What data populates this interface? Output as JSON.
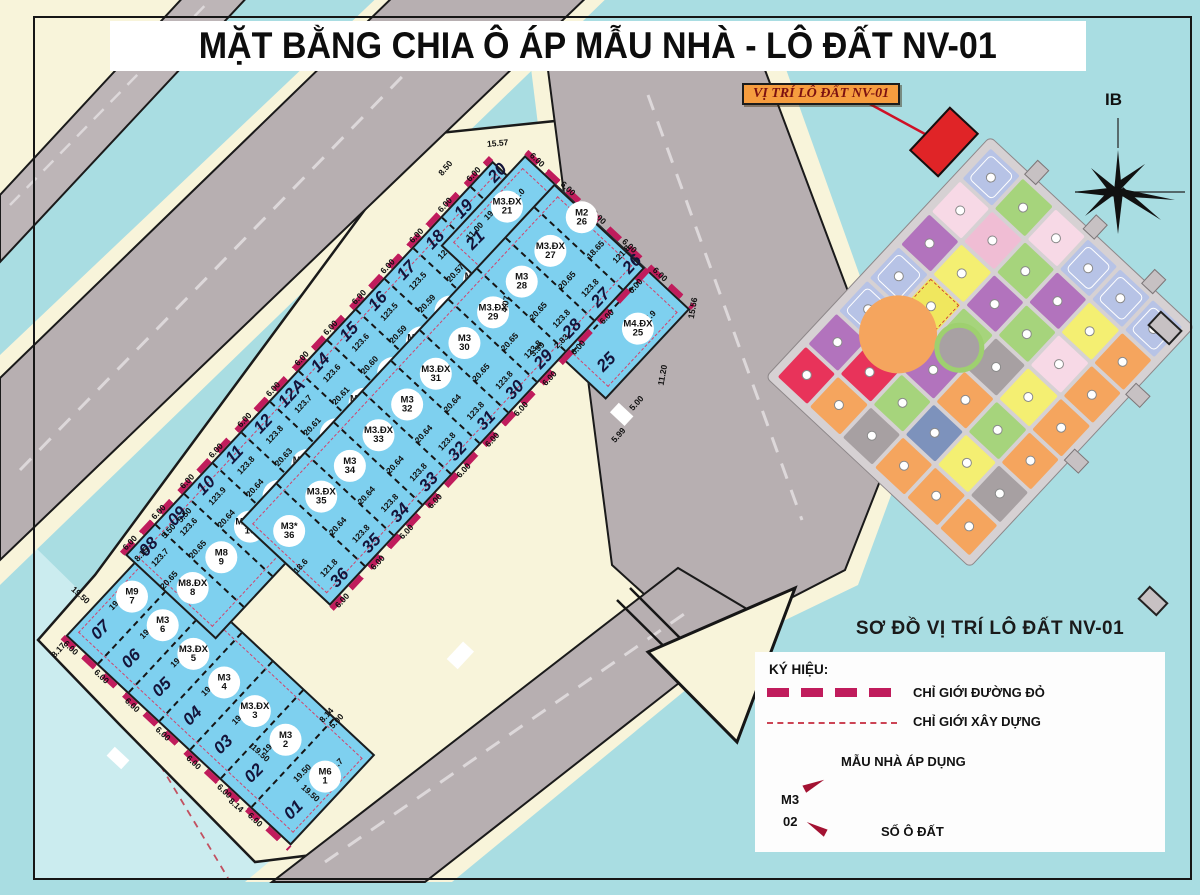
{
  "title": "MẶT BẰNG CHIA Ô ÁP MẪU NHÀ - LÔ ĐẤT NV-01",
  "callout": {
    "text": "VỊ TRÍ LÔ ĐẤT NV-01"
  },
  "compass": {
    "label": "IB"
  },
  "map_subtitle": "SƠ ĐỒ VỊ TRÍ LÔ ĐẤT NV-01",
  "legend": {
    "symbols_label": "KÝ HIỆU:",
    "red_boundary_label": "CHỈ GIỚI ĐƯỜNG ĐỎ",
    "setback_label": "CHỈ GIỚI XÂY DỰNG",
    "model_note": "MẪU NHÀ ÁP DỤNG",
    "model_example": "M3",
    "plot_number_example": "02",
    "plot_number_note": "SỐ Ô ĐẤT"
  },
  "colors": {
    "water": "#a9dde2",
    "water_light": "#cbecef",
    "land": "#f8f4da",
    "road": "#b7afb1",
    "plot_fill": "#7ed0ef",
    "red_boundary": "#c01c5c",
    "setback": "#cc4455",
    "highlight_plot": "#e02427",
    "callout_bg": "#f69d3f",
    "callout_text": "#7c1111"
  },
  "strips": {
    "width_dim": "6.00",
    "groups": {
      "leg1": {
        "plots": [
          {
            "num": "07",
            "model": "M9",
            "area": "",
            "depth": "19.50"
          },
          {
            "num": "06",
            "model": "M3",
            "area": "",
            "depth": "19.50"
          },
          {
            "num": "05",
            "model": "M3.ĐX",
            "area": "",
            "depth": "19.50"
          },
          {
            "num": "04",
            "model": "M3",
            "area": "",
            "depth": "19.50"
          },
          {
            "num": "03",
            "model": "M3.ĐX",
            "area": "",
            "depth": "19.50"
          },
          {
            "num": "02",
            "model": "M3",
            "area": "",
            "depth": "19.50"
          },
          {
            "num": "01",
            "model": "M6",
            "area": "156.7",
            "depth": "19.50",
            "wide": 64
          }
        ]
      },
      "leg2": {
        "plots": [
          {
            "num": "08",
            "model": "M8.ĐX",
            "area": "123.7",
            "depth": "20.65"
          },
          {
            "num": "09",
            "model": "M8",
            "area": "123.6",
            "depth": "20.65"
          },
          {
            "num": "10",
            "model": "M3.ĐX",
            "area": "123.9",
            "depth": "20.64"
          },
          {
            "num": "11",
            "model": "M3",
            "area": "123.8",
            "depth": "20.64"
          },
          {
            "num": "12",
            "model": "M3.ĐX",
            "area": "123.8",
            "depth": "20.63"
          },
          {
            "num": "12A",
            "model": "M3",
            "area": "123.7",
            "depth": "20.61"
          },
          {
            "num": "14",
            "model": "M3.ĐX",
            "area": "123.6",
            "depth": "20.61"
          },
          {
            "num": "15",
            "model": "M3",
            "area": "123.6",
            "depth": "20.60"
          },
          {
            "num": "16",
            "model": "M3.ĐX",
            "area": "123.5",
            "depth": "20.59"
          },
          {
            "num": "17",
            "model": "M3",
            "area": "123.5",
            "depth": "20.59"
          },
          {
            "num": "18",
            "model": "M3.ĐX",
            "area": "123.4",
            "depth": "20.57"
          },
          {
            "num": "19",
            "model": "M3*",
            "area": "121.4",
            "depth": "20.57"
          },
          {
            "num": "20",
            "model": "M4",
            "area": "150.7",
            "depth": "",
            "wide": 55
          }
        ]
      },
      "wing": {
        "plots": [
          {
            "num": "21",
            "model": "M3.ĐX",
            "area": "117.0",
            "depth": "19.51"
          },
          {
            "num": "22",
            "model": "M3",
            "area": "117.0",
            "depth": "19.51"
          },
          {
            "num": "23",
            "model": "M3.ĐX",
            "area": "117.0",
            "depth": "19.51"
          },
          {
            "num": "24",
            "model": "M3",
            "area": "117.0",
            "depth": "19.51"
          },
          {
            "num": "25",
            "model": "M4.ĐX",
            "area": "157.9",
            "depth": "",
            "wide": 62
          }
        ]
      },
      "strip2": {
        "plots": [
          {
            "num": "36",
            "model": "M3*",
            "area": "121.8",
            "depth": "18.6",
            "wide": 50
          },
          {
            "num": "35",
            "model": "M3.ĐX",
            "area": "123.8",
            "depth": "20.64"
          },
          {
            "num": "34",
            "model": "M3",
            "area": "123.8",
            "depth": "20.64"
          },
          {
            "num": "33",
            "model": "M3.ĐX",
            "area": "123.8",
            "depth": "20.64"
          },
          {
            "num": "32",
            "model": "M3",
            "area": "123.8",
            "depth": "20.64"
          },
          {
            "num": "31",
            "model": "M3.ĐX",
            "area": "123.8",
            "depth": "20.64"
          },
          {
            "num": "30",
            "model": "M3",
            "area": "123.8",
            "depth": "20.65"
          },
          {
            "num": "29",
            "model": "M3.ĐX",
            "area": "123.8",
            "depth": "20.65"
          },
          {
            "num": "28",
            "model": "M3",
            "area": "123.8",
            "depth": "20.65"
          },
          {
            "num": "27",
            "model": "M3.ĐX",
            "area": "123.8",
            "depth": "20.65"
          },
          {
            "num": "26",
            "model": "M2",
            "area": "121.8",
            "depth": "18.65",
            "wide": 48
          }
        ]
      }
    }
  },
  "extra_dims": [
    {
      "t": "15.57",
      "x": 487,
      "y": 138,
      "r": -5
    },
    {
      "t": "8.50",
      "x": 437,
      "y": 163,
      "r": -50
    },
    {
      "t": "11.00",
      "x": 464,
      "y": 226,
      "r": -47
    },
    {
      "t": "15.56",
      "x": 682,
      "y": 303,
      "r": -80
    },
    {
      "t": "4.07",
      "x": 497,
      "y": 299,
      "r": -80
    },
    {
      "t": "2.83",
      "x": 553,
      "y": 336,
      "r": -45
    },
    {
      "t": "3.99",
      "x": 529,
      "y": 344,
      "r": -45
    },
    {
      "t": "5.99",
      "x": 610,
      "y": 430,
      "r": -48
    },
    {
      "t": "5.00",
      "x": 628,
      "y": 398,
      "r": -48
    },
    {
      "t": "11.20",
      "x": 652,
      "y": 370,
      "r": -80
    },
    {
      "t": "8.15",
      "x": 133,
      "y": 549,
      "r": -48
    },
    {
      "t": "5.50",
      "x": 160,
      "y": 526,
      "r": -48
    },
    {
      "t": "5.50",
      "x": 176,
      "y": 510,
      "r": -48
    },
    {
      "t": "8.17",
      "x": 50,
      "y": 645,
      "r": -48
    },
    {
      "t": "19.50",
      "x": 70,
      "y": 590,
      "r": 42
    },
    {
      "t": "19.50",
      "x": 250,
      "y": 748,
      "r": 42
    },
    {
      "t": "19.50",
      "x": 300,
      "y": 788,
      "r": 42
    },
    {
      "t": "8.14",
      "x": 318,
      "y": 710,
      "r": -48
    },
    {
      "t": "8.14",
      "x": 228,
      "y": 800,
      "r": 42
    },
    {
      "t": "5.00",
      "x": 328,
      "y": 716,
      "r": -48
    }
  ],
  "master_plan": {
    "palette": {
      "L": "#b7c3e6",
      "G": "#a6d47c",
      "p": "#f7d9e6",
      "P": "#f0bdd4",
      "U": "#b273bd",
      "Y": "#f4ef72",
      "y": "#f0e75e",
      "O": "#f5a55e",
      "R": "#e8335a",
      "B": "#7d92bc",
      "g": "#a7a0a2"
    },
    "grid": [
      "L,G,p,L,L,L",
      "p,P,G,U,Y,O",
      "U,Y,U,G,p,O",
      "L,y,G,g,Y,O",
      "L,y,U,O,G,O",
      "U,R,G,B,Y,g",
      "R,O,g,O,O,O"
    ]
  }
}
